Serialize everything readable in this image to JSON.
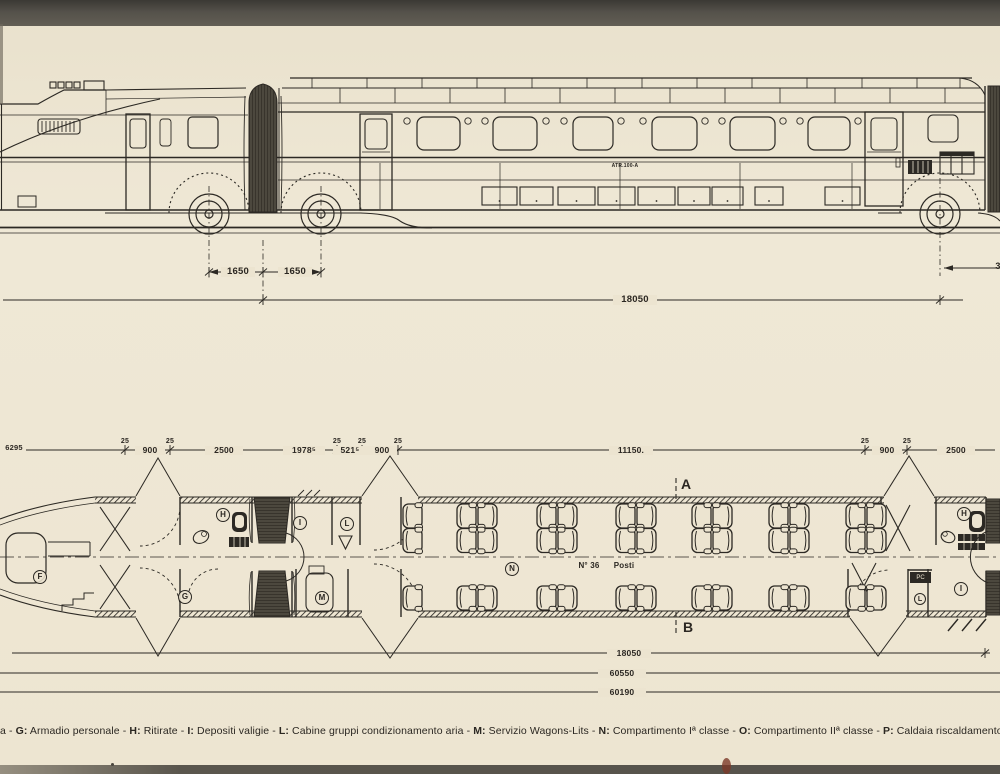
{
  "page": {
    "paper": "#ece4d0",
    "ink": "#2c2924",
    "top_band": "#54514a",
    "bottom_band": "#55524b"
  },
  "elevation": {
    "unit_label": "ATR.100-A",
    "dim_axle_left": "1650",
    "dim_axle_right": "1650",
    "dim_length": "18050",
    "dim_right_partial": "3"
  },
  "plan": {
    "dim_left_partial": "6295",
    "tick_label": "25",
    "chain_labels": [
      "900",
      "2500",
      "1978⁵",
      "521⁵",
      "900",
      "11150.",
      "900",
      "2500"
    ],
    "rooms": {
      "f": "F",
      "g": "G",
      "h_left": "H",
      "i_left": "I",
      "l_left": "L",
      "m": "M",
      "n": "N",
      "h_right": "H",
      "i_right": "I",
      "l_right": "L"
    },
    "pc_label": "PC",
    "seats_count": "N° 36",
    "seats_word": "Posti",
    "section_top": "A",
    "section_bottom": "B",
    "totals": [
      "18050",
      "60550",
      "60190"
    ]
  },
  "legend": {
    "lead_fragment": "a",
    "separator": " - ",
    "items": [
      {
        "key": "G",
        "desc": "Armadio personale"
      },
      {
        "key": "H",
        "desc": "Ritirate"
      },
      {
        "key": "I",
        "desc": "Depositi valigie"
      },
      {
        "key": "L",
        "desc": "Cabine gruppi condizionamento aria"
      },
      {
        "key": "M",
        "desc": "Servizio Wagons-Lits"
      },
      {
        "key": "N",
        "desc": "Compartimento Iª classe"
      },
      {
        "key": "O",
        "desc": "Compartimento IIª classe"
      },
      {
        "key": "P",
        "desc": "Caldaia riscaldamento"
      },
      {
        "key": "Q",
        "desc": "Posto del c"
      }
    ]
  }
}
